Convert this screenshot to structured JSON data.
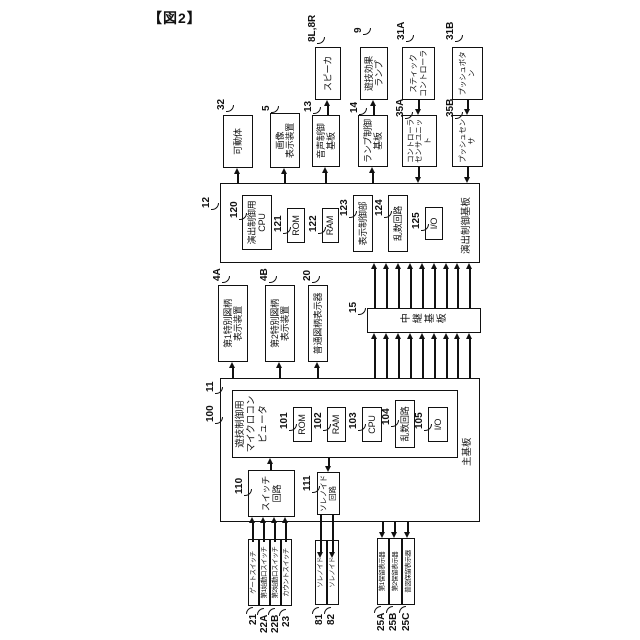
{
  "figure_label": "【図2】",
  "main_board": {
    "ref": "11",
    "label": "主基板",
    "microcomputer": {
      "ref": "100",
      "label": "遊技制御用\nマイクロコンピュータ"
    },
    "rom": {
      "ref": "101",
      "label": "ROM"
    },
    "ram": {
      "ref": "102",
      "label": "RAM"
    },
    "cpu": {
      "ref": "103",
      "label": "CPU"
    },
    "random_circuit": {
      "ref": "104",
      "label": "乱数回路"
    },
    "io": {
      "ref": "105",
      "label": "I/O"
    },
    "switch_circuit": {
      "ref": "110",
      "label": "スイッチ\n回路"
    },
    "solenoid_circuit": {
      "ref": "111",
      "label": "ソレノイド\n回路"
    }
  },
  "effect_board": {
    "ref": "12",
    "label": "演出制御基板",
    "cpu": {
      "ref": "120",
      "label": "演出制御用\nCPU"
    },
    "rom": {
      "ref": "121",
      "label": "ROM"
    },
    "ram": {
      "ref": "122",
      "label": "RAM"
    },
    "display_control": {
      "ref": "123",
      "label": "表示制御部"
    },
    "random_circuit": {
      "ref": "124",
      "label": "乱数回路"
    },
    "io": {
      "ref": "125",
      "label": "I/O"
    }
  },
  "relay_board": {
    "ref": "15",
    "label": "中継基板"
  },
  "symbol_displays": {
    "special1": {
      "ref": "4A",
      "label": "第1特別図柄\n表示装置"
    },
    "special2": {
      "ref": "4B",
      "label": "第2特別図柄\n表示装置"
    },
    "normal": {
      "ref": "20",
      "label": "普通図柄表示器"
    }
  },
  "devices": {
    "movable": {
      "ref": "32",
      "label": "可動体"
    },
    "image_display": {
      "ref": "5",
      "label": "画像\n表示装置"
    },
    "sound_board": {
      "ref": "13",
      "label": "音声制御\n基板"
    },
    "speaker": {
      "ref": "8L,8R",
      "label": "スピーカ"
    },
    "lamp_board": {
      "ref": "14",
      "label": "ランプ制御\n基板"
    },
    "effect_lamp": {
      "ref": "9",
      "label": "遊技効果\nランプ"
    },
    "controller_sensor": {
      "ref": "35A",
      "label": "コントローラ\nセンサユニット"
    },
    "stick_controller": {
      "ref": "31A",
      "label": "スティック\nコントローラ"
    },
    "push_sensor": {
      "ref": "35B",
      "label": "プッシュセンサ"
    },
    "push_button": {
      "ref": "31B",
      "label": "プッシュボタン"
    }
  },
  "inputs": {
    "gate_switch": {
      "ref": "21",
      "label": "ゲートスイッチ"
    },
    "start1_switch": {
      "ref": "22A",
      "label": "第1始動口スイッチ"
    },
    "start2_switch": {
      "ref": "22B",
      "label": "第2始動口スイッチ"
    },
    "count_switch": {
      "ref": "23",
      "label": "カウントスイッチ"
    }
  },
  "outputs": {
    "solenoid1": {
      "ref": "81",
      "label": "ソレノイド"
    },
    "solenoid2": {
      "ref": "82",
      "label": "ソレノイド"
    }
  },
  "hold_displays": {
    "hold1": {
      "ref": "25A",
      "label": "第1保留表示器"
    },
    "hold2": {
      "ref": "25B",
      "label": "第2保留表示器"
    },
    "hold3": {
      "ref": "25C",
      "label": "普図保留表示器"
    }
  }
}
